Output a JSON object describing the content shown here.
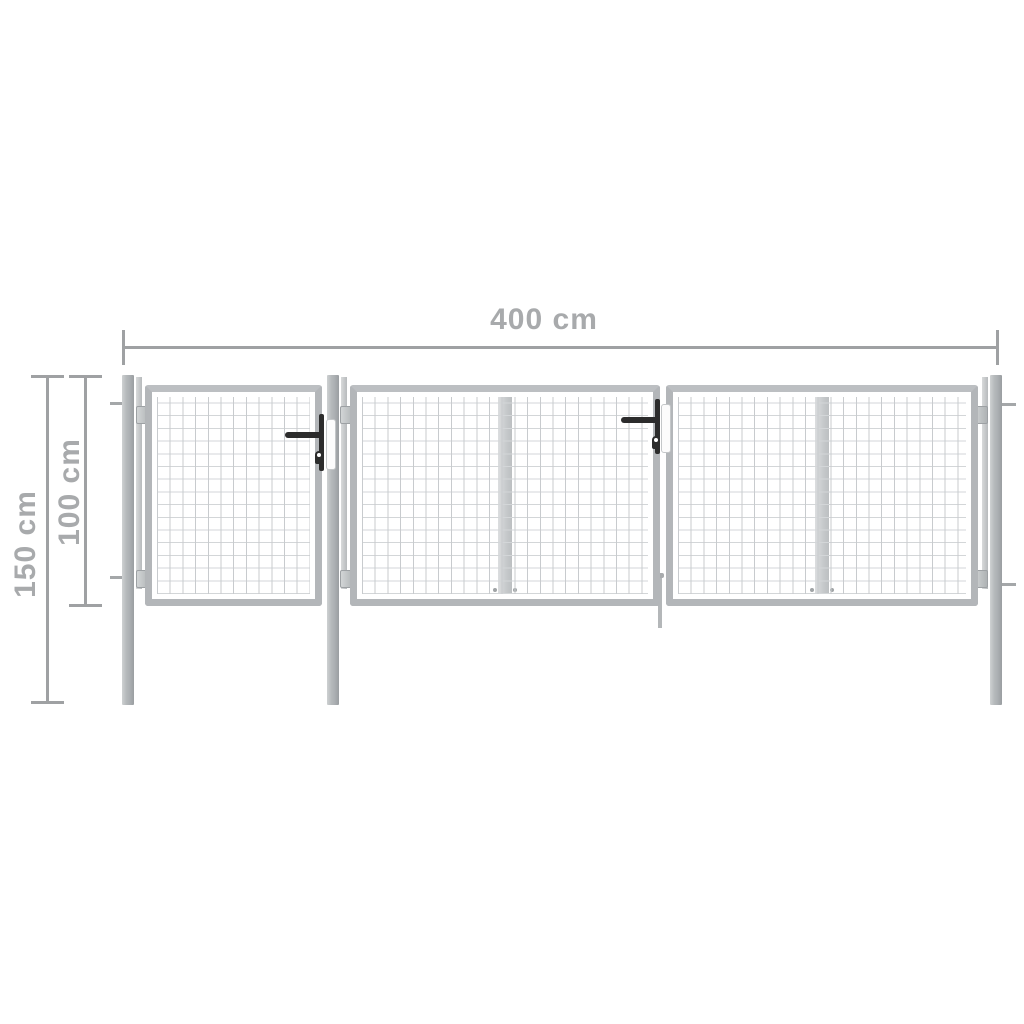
{
  "scene": {
    "type": "product-dimension-diagram",
    "subject": "mesh garden gate with three panels and four posts"
  },
  "diagram": {
    "labels": {
      "width": "400 cm",
      "total_height": "150 cm",
      "gate_height": "100 cm"
    },
    "colors": {
      "background": "#ffffff",
      "dimension_line": "#9fa1a3",
      "dimension_text": "#a8aaac",
      "frame": "#b3b6b9",
      "mesh_line": "#c8cbce",
      "post_light": "#ced1d2",
      "post_dark": "#9a9ea1",
      "handle": "#2c2c2c"
    }
  }
}
